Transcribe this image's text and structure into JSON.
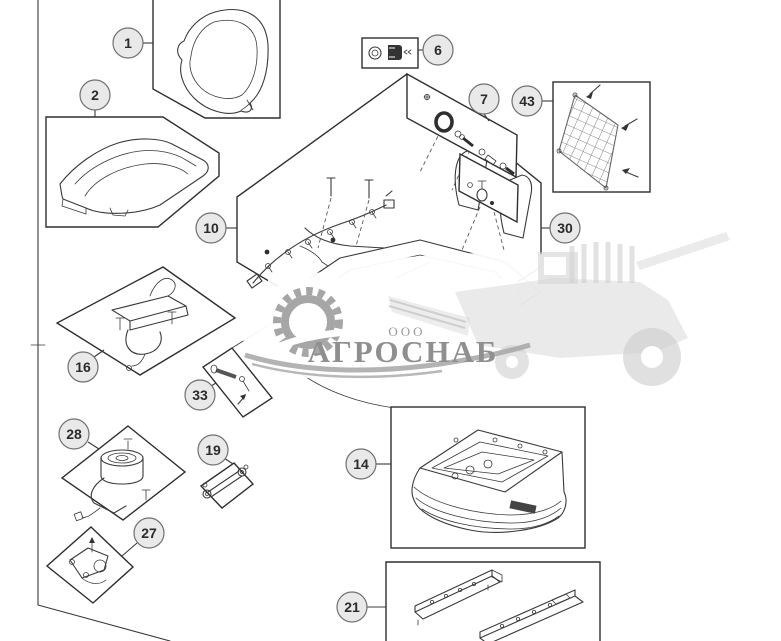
{
  "style": {
    "line": "#3a3a3a",
    "box_stroke": "#2f2f2f",
    "callout_fill": "#e9e9e9",
    "callout_stroke": "#707070",
    "callout_text": "#2b2b2b",
    "wm_text": "#8f8f8f",
    "wm_logo": "#a6a6a6",
    "wm_machine": "#d8d8d8"
  },
  "watermark": {
    "prefix": "ООО",
    "name": "АГРОСНАБ"
  },
  "callouts": [
    {
      "label": "1"
    },
    {
      "label": "2"
    },
    {
      "label": "6"
    },
    {
      "label": "7"
    },
    {
      "label": "43"
    },
    {
      "label": "10"
    },
    {
      "label": "30"
    },
    {
      "label": "16"
    },
    {
      "label": "33"
    },
    {
      "label": "28"
    },
    {
      "label": "19"
    },
    {
      "label": "27"
    },
    {
      "label": "14"
    },
    {
      "label": "21"
    }
  ]
}
